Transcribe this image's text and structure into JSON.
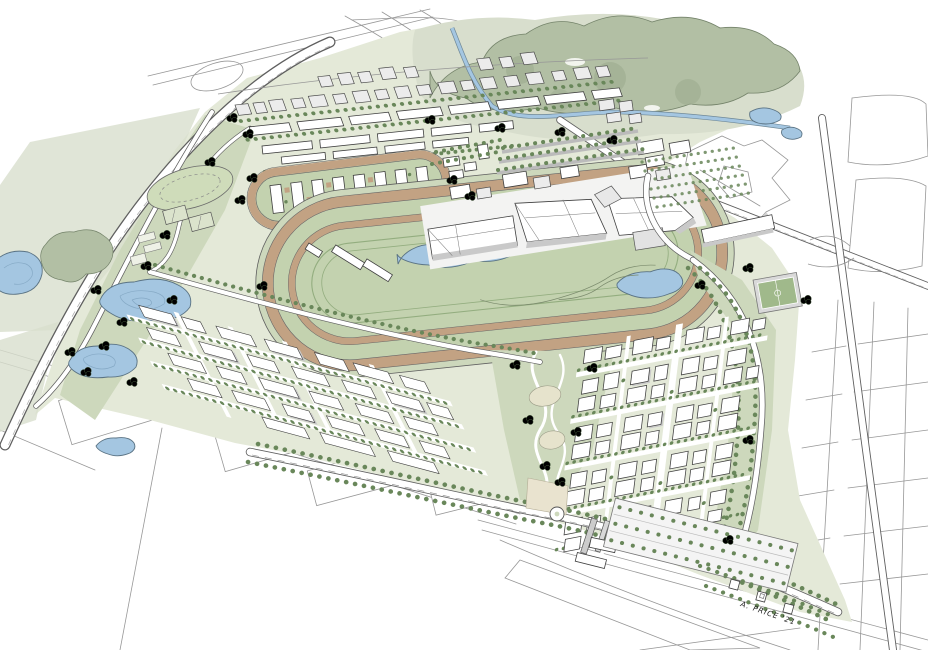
{
  "illustration": {
    "signature": "A. PRICE '21"
  },
  "palette": {
    "site": "#e4e9d8",
    "park": "#cdd8bc",
    "infield": "#c3d2af",
    "track": "#c2a283",
    "water": "#a4c6e1",
    "waterEdge": "#5a7384",
    "forest": "#b2bfa4",
    "forestLight": "#d8decd",
    "tree": "#69875a",
    "treeDark": "#4f7045",
    "pitch": "#a0b98b",
    "ink": "#3a3a3a",
    "faint": "#979797",
    "roof": "#ececec",
    "shade": "#c9c9c9",
    "plaza": "#e9e3cf"
  }
}
